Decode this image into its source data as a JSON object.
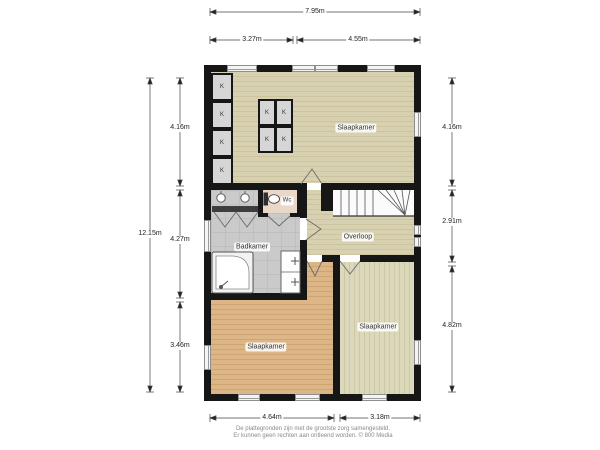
{
  "rooms": {
    "bedroom_top": "Slaapkamer",
    "bedroom_bottom_left": "Slaapkamer",
    "bedroom_bottom_right": "Slaapkamer",
    "bathroom": "Badkamer",
    "wc": "Wc",
    "landing": "Overloop",
    "closet": "K"
  },
  "dims": {
    "top_total": "7.95m",
    "top_left": "3.27m",
    "top_right": "4.55m",
    "left_total": "12.15m",
    "left_top": "4.16m",
    "left_middle": "4.27m",
    "left_bottom": "3.46m",
    "right_top": "4.16m",
    "right_middle": "2.91m",
    "right_bottom": "4.82m",
    "bottom_left": "4.64m",
    "bottom_right": "3.18m"
  },
  "footer": {
    "line1": "De plattegronden zijn met de grootste zorg samengesteld.",
    "line2": "Er kunnen geen rechten aan ontleend worden. © 800 Media"
  },
  "colors": {
    "wall": "#161616",
    "wood_beige": "#d8d1b1",
    "wood_orange": "#dcb687",
    "wood_pale": "#dcd8bc",
    "tile_gray": "#cacaca",
    "wc_floor": "#e9d8c8"
  }
}
